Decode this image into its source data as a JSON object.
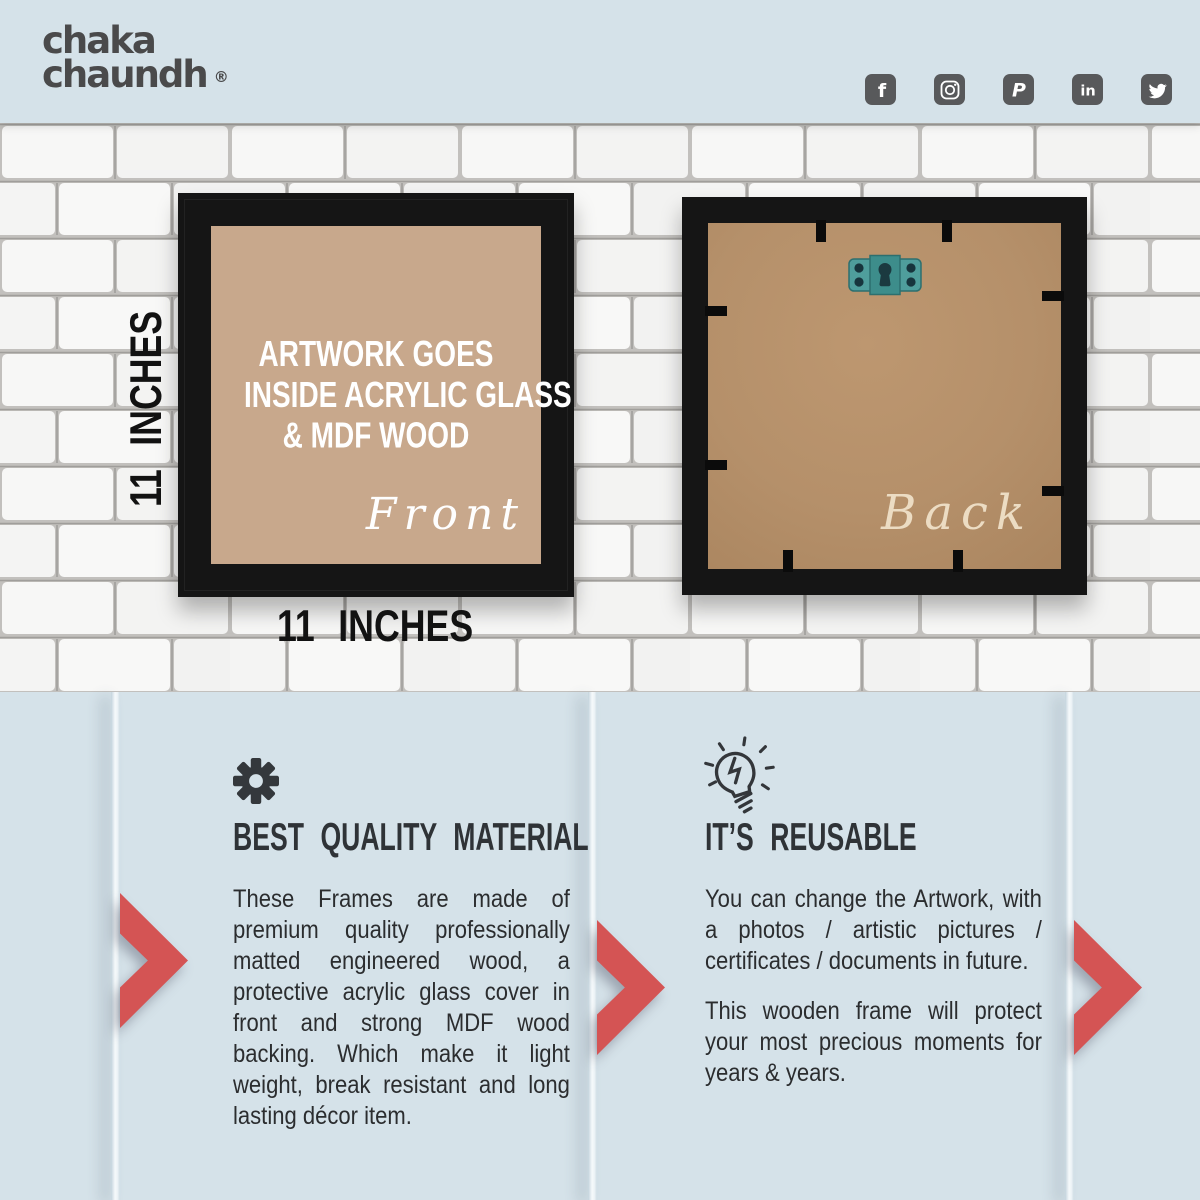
{
  "brand": {
    "name_line1": "chaka",
    "name_line2": "chaundh",
    "registered_mark": "®"
  },
  "social": {
    "icons": [
      {
        "name": "facebook",
        "glyph": "f"
      },
      {
        "name": "instagram",
        "glyph": ""
      },
      {
        "name": "pinterest",
        "glyph": "P"
      },
      {
        "name": "linkedin",
        "glyph": "in"
      },
      {
        "name": "twitter",
        "glyph": ""
      }
    ]
  },
  "frames": {
    "front": {
      "note_line1": "ARTWORK GOES",
      "note_line2": "INSIDE ACRYLIC GLASS",
      "note_line3": "& MDF WOOD",
      "caption": "Front"
    },
    "back": {
      "caption": "Back"
    },
    "height_label": "11 INCHES",
    "width_label": "11 INCHES"
  },
  "features": {
    "quality": {
      "icon": "gear-icon",
      "heading": "BEST QUALITY MATERIAL",
      "body": "These Frames are made of premium quality professionally matted engineered wood, a protective acrylic glass cover in front and strong MDF wood backing. Which make it light weight, break resistant and long lasting décor item."
    },
    "reusable": {
      "icon": "lightbulb-icon",
      "heading": "IT’S REUSABLE",
      "body_1": "You can change the Artwork, with a photos / artistic pictures / certificates / documents in future.",
      "body_2": "This wooden frame will protect your most precious moments for years & years."
    }
  },
  "colors": {
    "background_blue": "#d5e2e9",
    "accent_red": "#d45454",
    "frame_black": "#151515",
    "front_matte_tan": "#c8a88c",
    "mdf_brown": "#b5906a",
    "bracket_teal": "#4f9e9c",
    "text_dark": "#2f3337"
  }
}
